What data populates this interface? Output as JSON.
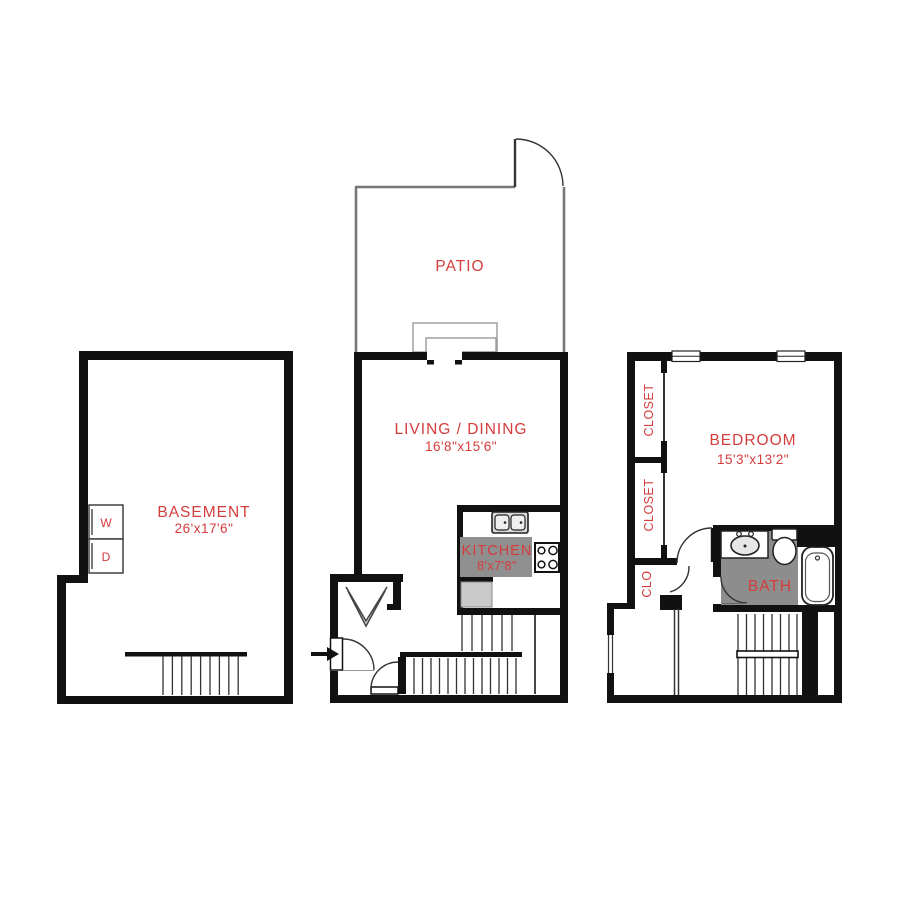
{
  "title": "Apartment floor plan",
  "colors": {
    "wall": "#111111",
    "label_red": "#d53c3c",
    "bath_floor": "#8d8d8d",
    "kitchen_counter": "#8f8f8f",
    "appliance_gray": "#c9c9c9",
    "background": "#ffffff"
  },
  "basement": {
    "label": "BASEMENT",
    "dims": "26'x17'6\"",
    "washer_label": "W",
    "dryer_label": "D"
  },
  "main_floor": {
    "patio_label": "PATIO",
    "living_label": "LIVING / DINING",
    "living_dims": "16'8\"x15'6\"",
    "kitchen_label": "KITCHEN",
    "kitchen_dims": "8'x7'8\""
  },
  "upper_floor": {
    "bedroom_label": "BEDROOM",
    "bedroom_dims": "15'3\"x13'2\"",
    "closet_upper_label": "CLOSET",
    "closet_lower_label": "CLOSET",
    "clo_label": "CLO",
    "bath_label": "BATH"
  }
}
